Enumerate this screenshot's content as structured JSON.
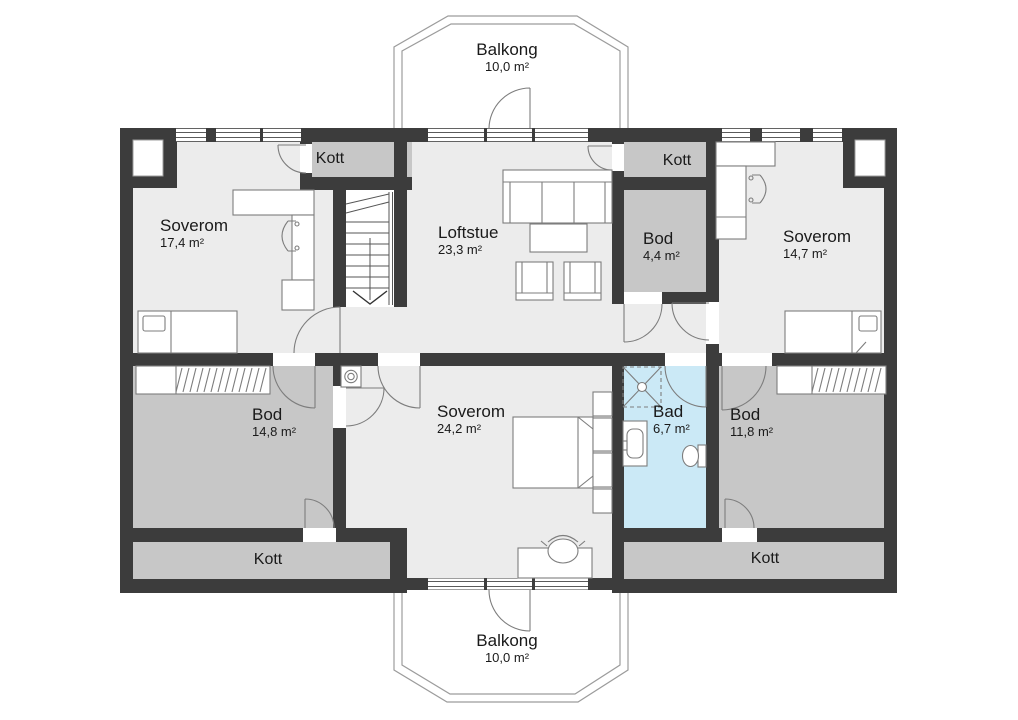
{
  "floorplan": {
    "rooms": [
      {
        "id": "balkong_top",
        "name": "Balkong",
        "area": "10,0 m²"
      },
      {
        "id": "kott_top_left",
        "name": "Kott",
        "area": ""
      },
      {
        "id": "soverom_nw",
        "name": "Soverom",
        "area": "17,4 m²"
      },
      {
        "id": "loftstue",
        "name": "Loftstue",
        "area": "23,3 m²"
      },
      {
        "id": "bod_44",
        "name": "Bod",
        "area": "4,4 m²"
      },
      {
        "id": "kott_top_right",
        "name": "Kott",
        "area": ""
      },
      {
        "id": "soverom_ne",
        "name": "Soverom",
        "area": "14,7 m²"
      },
      {
        "id": "bod_sw",
        "name": "Bod",
        "area": "14,8 m²"
      },
      {
        "id": "soverom_s",
        "name": "Soverom",
        "area": "24,2 m²"
      },
      {
        "id": "bad",
        "name": "Bad",
        "area": "6,7 m²"
      },
      {
        "id": "bod_se",
        "name": "Bod",
        "area": "11,8 m²"
      },
      {
        "id": "kott_bottom_left",
        "name": "Kott",
        "area": ""
      },
      {
        "id": "kott_bottom_right",
        "name": "Kott",
        "area": ""
      },
      {
        "id": "balkong_bottom",
        "name": "Balkong",
        "area": "10,0 m²"
      }
    ],
    "colors": {
      "wall": "#3c3c3c",
      "floor": "#ececec",
      "storage": "#c7c7c7",
      "bathroom": "#cbe9f6",
      "outline": "#9c9c9c",
      "furniture": "#7d7d7d",
      "glass": "#5a5a5a"
    }
  }
}
